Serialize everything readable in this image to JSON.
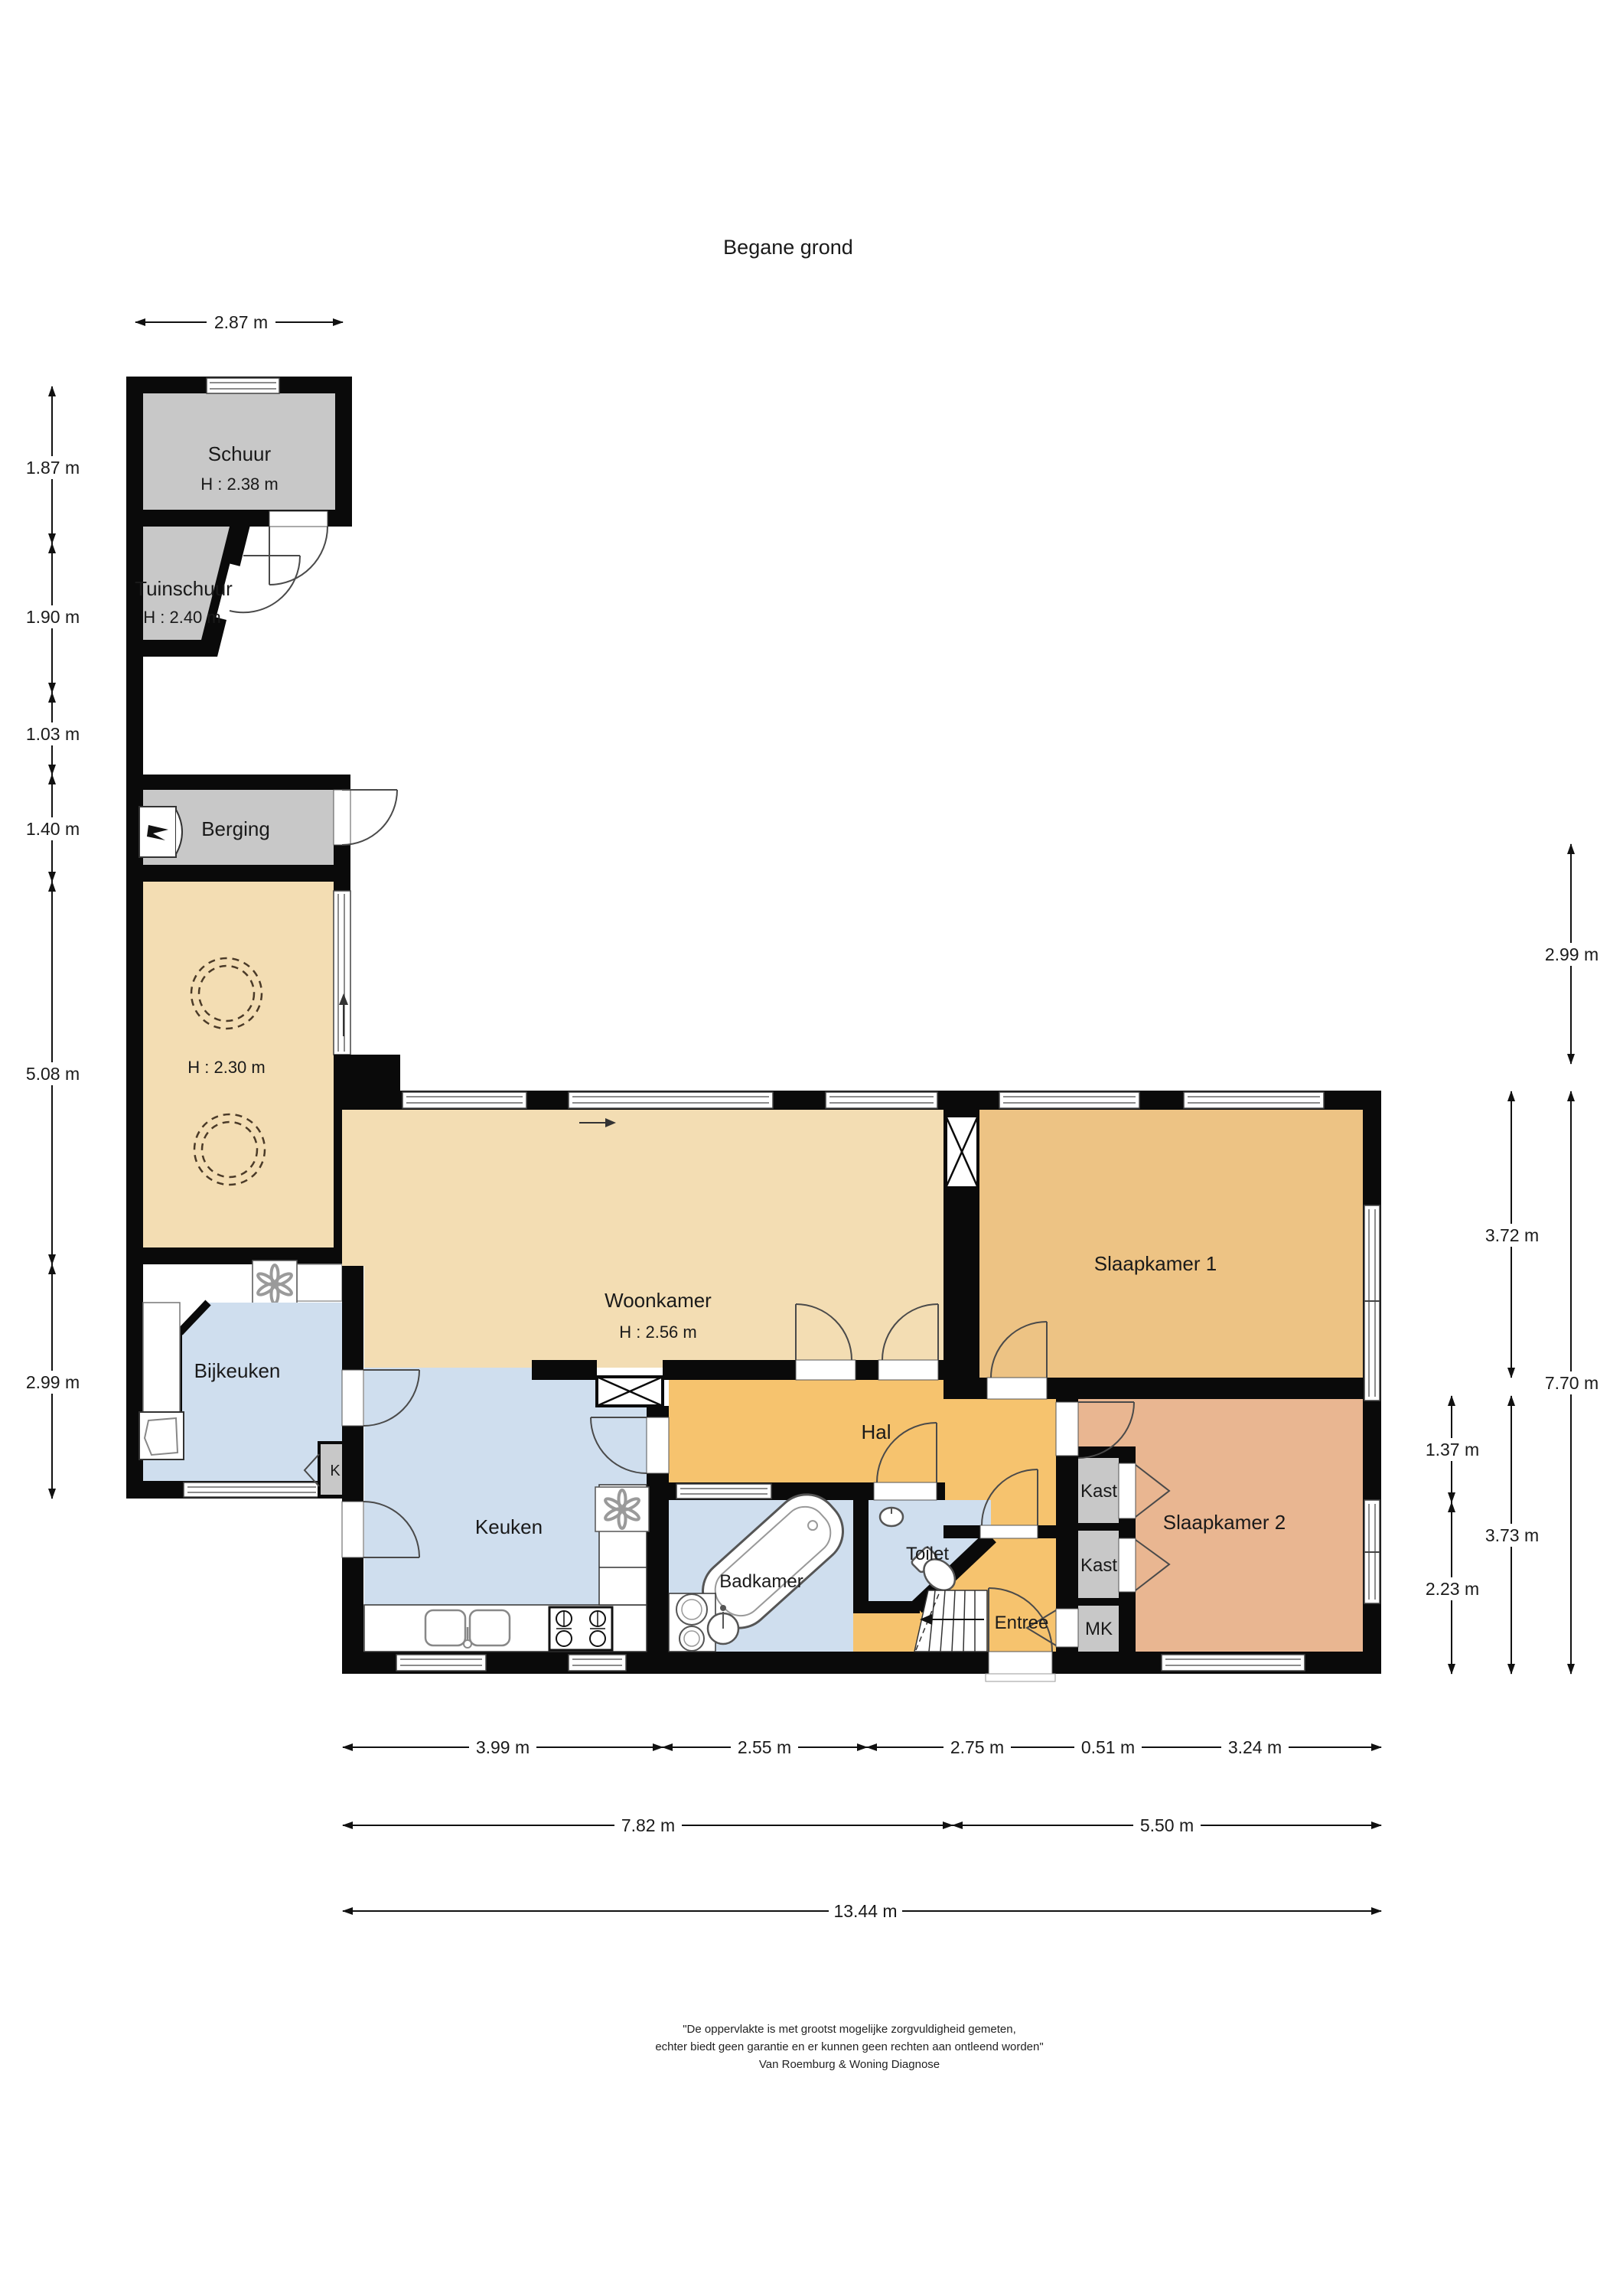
{
  "title": "Begane grond",
  "rooms": {
    "schuur": {
      "label": "Schuur",
      "height": "H : 2.38 m"
    },
    "tuinschuur": {
      "label": "Tuinschuur",
      "height": "H : 2.40 m"
    },
    "berging": {
      "label": "Berging"
    },
    "hobby": {
      "height": "H : 2.30 m"
    },
    "woonkamer": {
      "label": "Woonkamer",
      "height": "H : 2.56 m"
    },
    "slaapkamer1": {
      "label": "Slaapkamer 1"
    },
    "bijkeuken": {
      "label": "Bijkeuken"
    },
    "keuken": {
      "label": "Keuken"
    },
    "hal": {
      "label": "Hal"
    },
    "toilet": {
      "label": "Toilet"
    },
    "badkamer": {
      "label": "Badkamer"
    },
    "entree": {
      "label": "Entree"
    },
    "slaapkamer2": {
      "label": "Slaapkamer 2"
    },
    "kast1": {
      "label": "Kast"
    },
    "kast2": {
      "label": "Kast"
    },
    "mk": {
      "label": "MK"
    },
    "k": {
      "label": "K"
    }
  },
  "dimensions": {
    "top": "2.87 m",
    "left": [
      "1.87 m",
      "1.90 m",
      "1.03 m",
      "1.40 m",
      "5.08 m",
      "2.99 m"
    ],
    "right": [
      "2.99 m",
      "3.72 m",
      "7.70 m",
      "1.37 m",
      "3.73 m",
      "2.23 m"
    ],
    "bottom1": [
      "3.99 m",
      "2.55 m",
      "2.75 m",
      "0.51 m",
      "3.24 m"
    ],
    "bottom2": [
      "7.82 m",
      "5.50 m"
    ],
    "bottom3": [
      "13.44 m"
    ]
  },
  "footer": {
    "line1": "\"De oppervlakte is met grootst mogelijke zorgvuldigheid gemeten,",
    "line2": "echter biedt geen garantie en er kunnen geen rechten aan ontleend worden\"",
    "line3": "Van Roemburg & Woning Diagnose"
  },
  "colors": {
    "wall": "#0a0a0a",
    "shed_gray": "#c8c8c8",
    "living_tan": "#f3ddb3",
    "bedroom1_orange": "#edc384",
    "hall_orange": "#f6c36e",
    "bedroom2_salmon": "#e9b691",
    "wet_blue": "#cfdeee"
  }
}
